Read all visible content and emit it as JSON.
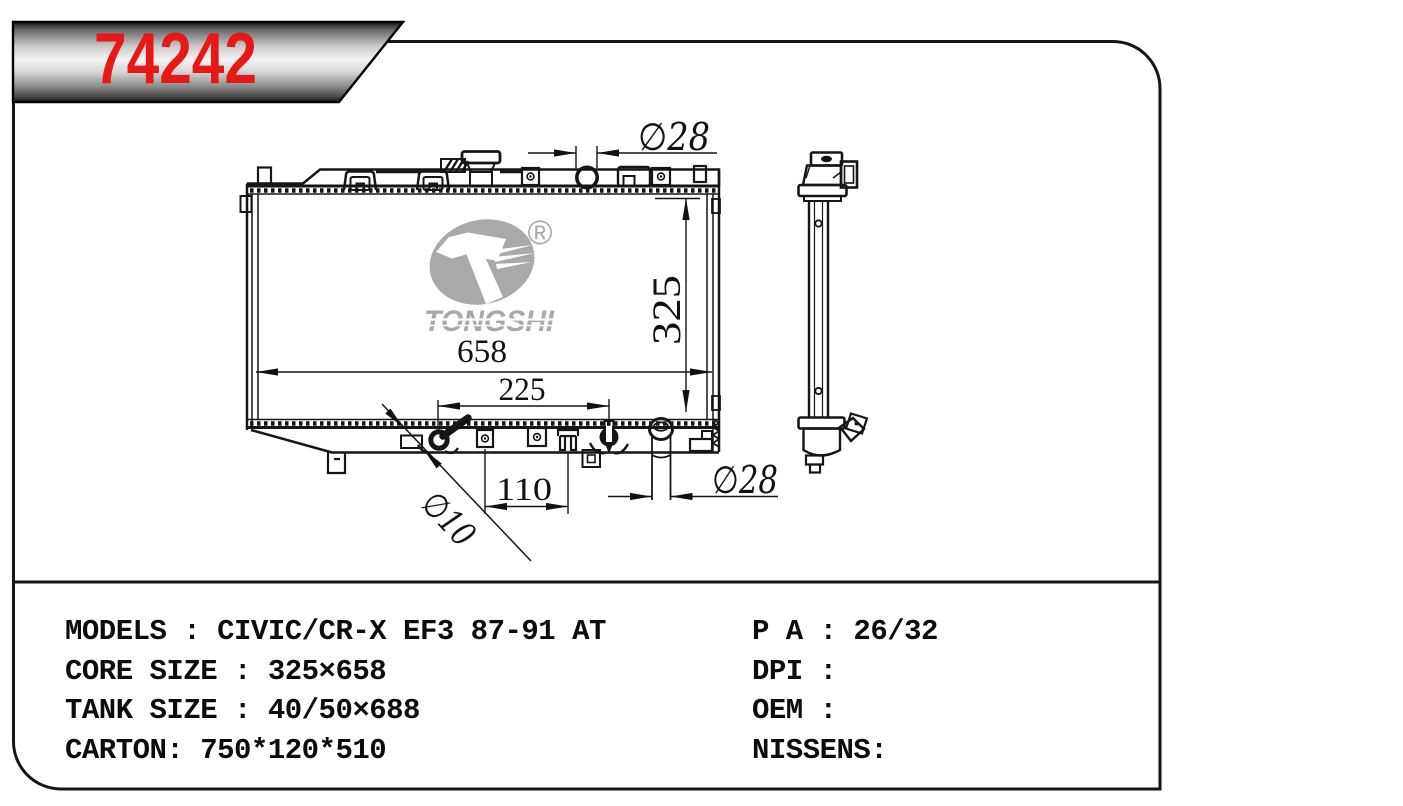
{
  "banner": {
    "part_number": "74242",
    "accent_color": "#e71818"
  },
  "logo": {
    "wordmark": "TONGSHI",
    "registered": "®",
    "color": "#a9a9a9"
  },
  "drawing": {
    "dimensions": {
      "top_port_diameter": "∅28",
      "overall_width": "658",
      "core_height": "325",
      "port_spacing": "225",
      "bracket_spacing": "110",
      "drain_diameter": "∅10",
      "bottom_port_diameter": "∅28"
    }
  },
  "specs": {
    "left": [
      "MODELS : CIVIC/CR-X EF3 87-91 AT",
      "CORE SIZE : 325×658",
      "TANK SIZE : 40/50×688",
      "CARTON: 750*120*510"
    ],
    "right": [
      "P A : 26/32",
      "DPI :",
      "OEM :",
      "NISSENS:"
    ]
  }
}
